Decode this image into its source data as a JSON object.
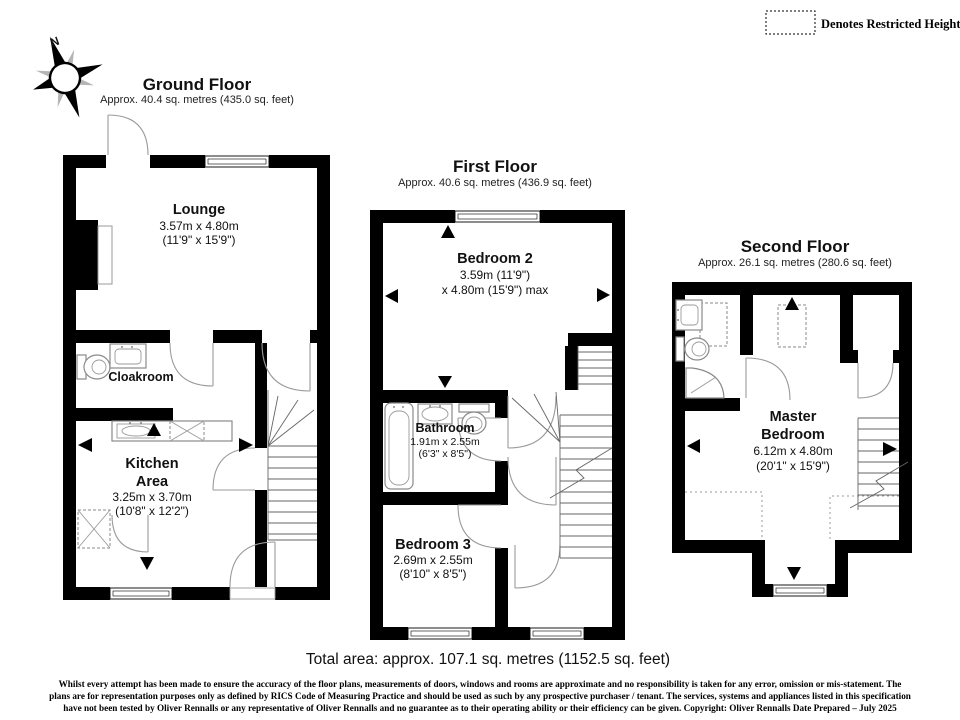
{
  "legend": {
    "restricted_height_label": "Denotes Restricted Height"
  },
  "compass": {
    "north_label": "N"
  },
  "ground_floor": {
    "title": "Ground Floor",
    "area": "Approx. 40.4 sq. metres (435.0 sq. feet)",
    "lounge_name": "Lounge",
    "lounge_dims_m": "3.57m x 4.80m",
    "lounge_dims_ft": "(11'9\" x 15'9\")",
    "cloakroom_name": "Cloakroom",
    "kitchen_name_1": "Kitchen",
    "kitchen_name_2": "Area",
    "kitchen_dims_m": "3.25m x 3.70m",
    "kitchen_dims_ft": "(10'8\" x 12'2\")"
  },
  "first_floor": {
    "title": "First Floor",
    "area": "Approx. 40.6 sq. metres (436.9 sq. feet)",
    "bedroom2_name": "Bedroom 2",
    "bedroom2_dims_1": "3.59m (11'9\")",
    "bedroom2_dims_2": "x 4.80m (15'9\") max",
    "bathroom_name": "Bathroom",
    "bathroom_dims_m": "1.91m x 2.55m",
    "bathroom_dims_ft": "(6'3\" x 8'5\")",
    "bedroom3_name": "Bedroom 3",
    "bedroom3_dims_m": "2.69m x 2.55m",
    "bedroom3_dims_ft": "(8'10\" x 8'5\")"
  },
  "second_floor": {
    "title": "Second Floor",
    "area": "Approx. 26.1 sq. metres (280.6 sq. feet)",
    "master_name_1": "Master",
    "master_name_2": "Bedroom",
    "master_dims_m": "6.12m x 4.80m",
    "master_dims_ft": "(20'1\" x 15'9\")"
  },
  "total_area": "Total area: approx. 107.1 sq. metres (1152.5 sq. feet)",
  "disclaimer_line1": "Whilst every attempt has been made to ensure the accuracy of the floor plans, measurements of doors, windows and rooms are approximate and no responsibility is taken for any error, omission or mis-statement. The",
  "disclaimer_line2": "plans are for representation purposes only as defined by RICS Code of Measuring Practice and should be used as such by any prospective purchaser / tenant. The services, systems and appliances listed in this specification",
  "disclaimer_line3": "have not been tested by Oliver Rennalls or any representative of Oliver Rennalls and no guarantee as to their operating ability or their efficiency can be given. Copyright: Oliver Rennalls Date Prepared – July 2025",
  "colors": {
    "wall": "#000000",
    "fixture": "#8a8a8a",
    "background": "#ffffff"
  }
}
